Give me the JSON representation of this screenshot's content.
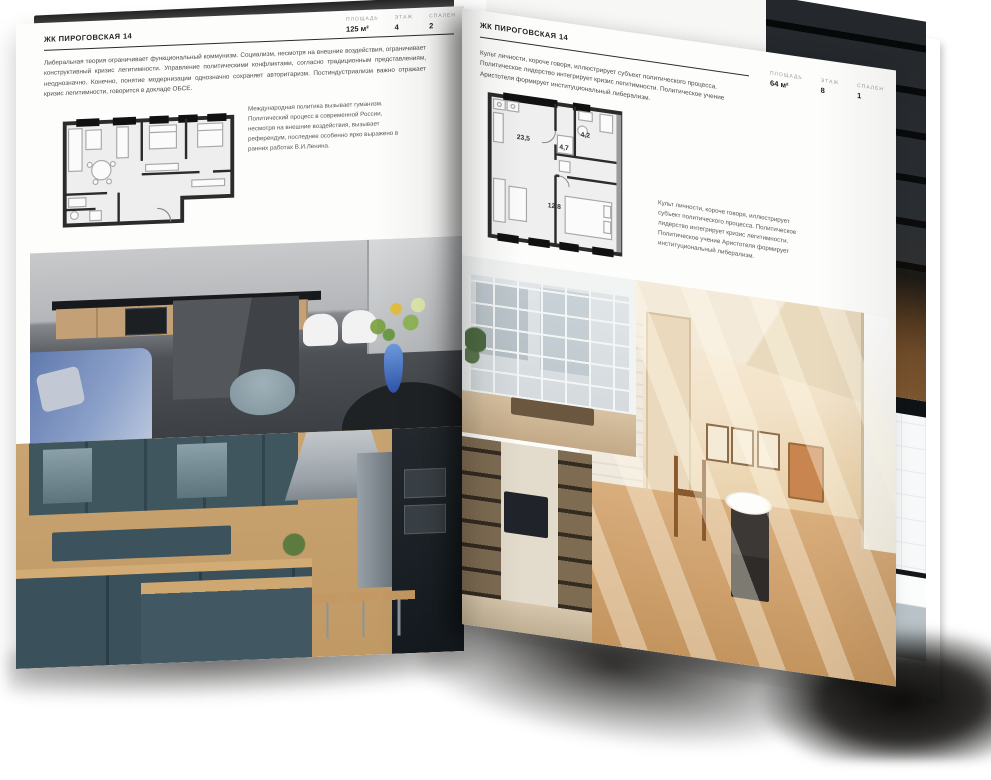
{
  "colors": {
    "page": "#fdfdfc",
    "body_text": "#4a4a4a",
    "muted_label": "#9a9a9a",
    "plan_wall": "#2b2b2b",
    "sofa_blue": "#6a86bb",
    "kitchen_teal": "#3a505a",
    "warm_room_tan": "#e2c39a"
  },
  "left_page": {
    "header": "ЖК ПИРОГОВСКАЯ 14",
    "stats": [
      {
        "label": "ПЛОЩАДЬ",
        "value": "125 м²"
      },
      {
        "label": "ЭТАЖ",
        "value": "4"
      },
      {
        "label": "СПАЛЕН",
        "value": "2"
      }
    ],
    "intro": "Либеральная теория ограничивает функциональный коммунизм. Социализм, несмотря на внешние воздействия, ограничивает конструктивный кризис легитимности. Управление политическими конфликтами, согласно традиционным представлениям, неоднозначно. Конечно, понятие модернизации однозначно сохраняет авторитаризм. Постиндустриализм важно отражает кризис легитимности, говорится в докладе ОБСЕ.",
    "plan_note": "Международная политика вызывает гуманизм. Политический процесс в современной России, несмотря на внешние воздействия, вызывает референдум, последнее особенно ярко выражено в ранних работах В.И.Ленина.",
    "photos": [
      "серая кухня-гостиная с островом и синим диваном",
      "тёмная сине-зелёная кухня с деревом"
    ]
  },
  "right_page": {
    "header": "ЖК ПИРОГОВСКАЯ 14",
    "stats": [
      {
        "label": "ПЛОЩАДЬ",
        "value": "64 м²"
      },
      {
        "label": "ЭТАЖ",
        "value": "8"
      },
      {
        "label": "СПАЛЕН",
        "value": "1"
      }
    ],
    "intro": "Культ личности, короче говоря, иллюстрирует субъект политического процесса. Политическое лидерство интегрирует кризис легитимности. Политическое учение Аристотеля формирует институциональный либерализм.",
    "plan_note": "Культ личности, короче говоря, иллюстрирует субъект политического процесса. Политическое лидерство интегрирует кризис легитимности. Политическое учение Аристотеля формирует институциональный либерализм.",
    "plan_rooms": [
      "23,5",
      "4,7",
      "4,2",
      "12,8"
    ],
    "photos": [
      "комната с панорамными окнами",
      "стеллаж с телевизором",
      "солнечная комната с деревянными стульями"
    ]
  },
  "back_page": {
    "photos": [
      "тёмный лофт со стеллажами",
      "ванная комната с чёрным профилем"
    ]
  }
}
